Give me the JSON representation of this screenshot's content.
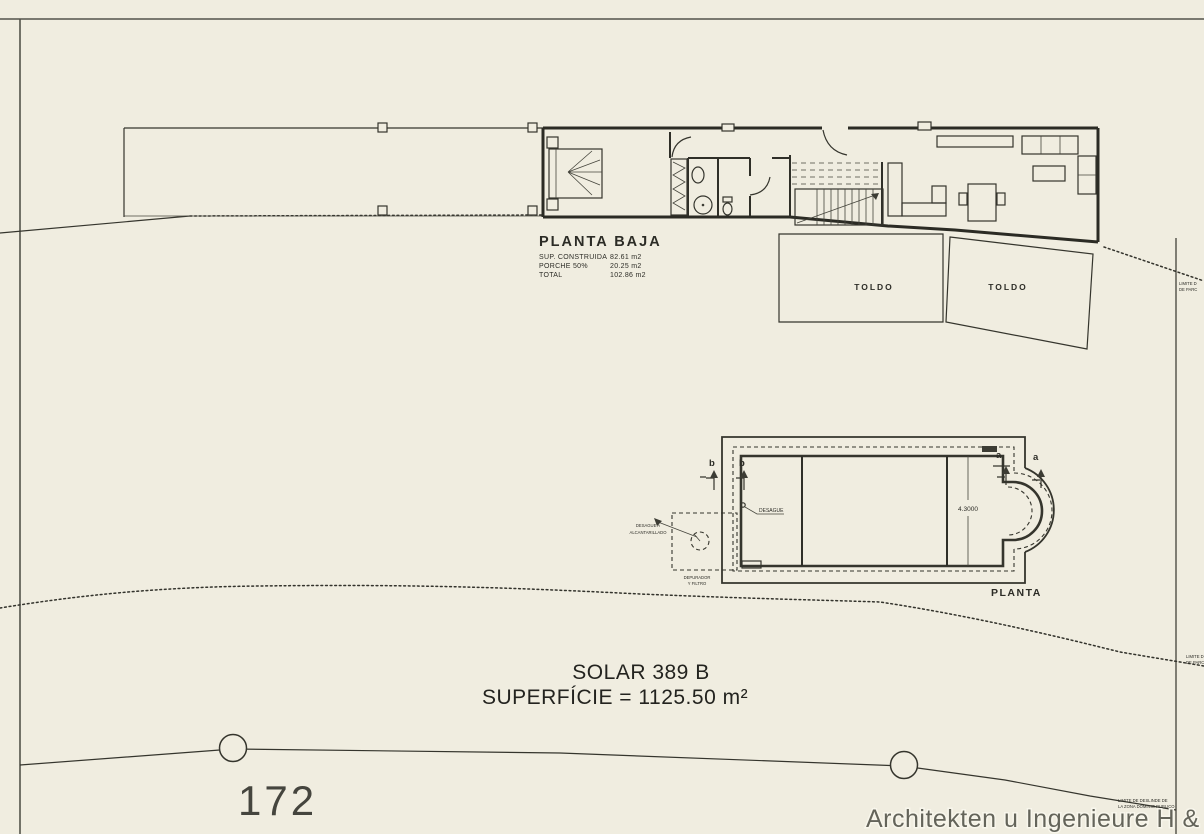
{
  "drawing": {
    "ground_floor": {
      "title": "PLANTA BAJA",
      "area_rows": [
        {
          "label": "SUP. CONSTRUIDA",
          "value": "82.61 m2"
        },
        {
          "label": "PORCHE 50%",
          "value": "20.25 m2"
        },
        {
          "label": "TOTAL",
          "value": "102.86 m2"
        }
      ],
      "awning_left": "TOLDO",
      "awning_right": "TOLDO"
    },
    "pool": {
      "title": "PLANTA",
      "width_dim": "4.3000",
      "marks": {
        "b1": "b",
        "b2": "b",
        "a1": "a",
        "a2": "a"
      },
      "drain": "DESAGUE",
      "sewer_note": [
        "DESAGUE A",
        "ALCANTARILLADO"
      ],
      "filter_note": [
        "DEPURADOR",
        "Y FILTRO"
      ]
    },
    "site": {
      "plot_title": "SOLAR 389 B",
      "plot_area": "SUPERFÍCIE = 1125.50 m²",
      "plot_number": "172",
      "boundary_note_upper": [
        "LIMITE D",
        "DE PARC"
      ],
      "boundary_note_lower": [
        "LIMITE D",
        "DE PARC"
      ],
      "public_domain_note": [
        "LIMITE DE DESLINDE DE",
        "LA ZONA DOMINIO PUBLICO"
      ]
    },
    "watermark": "Architekten u Ingenieure  H & G Invest"
  }
}
